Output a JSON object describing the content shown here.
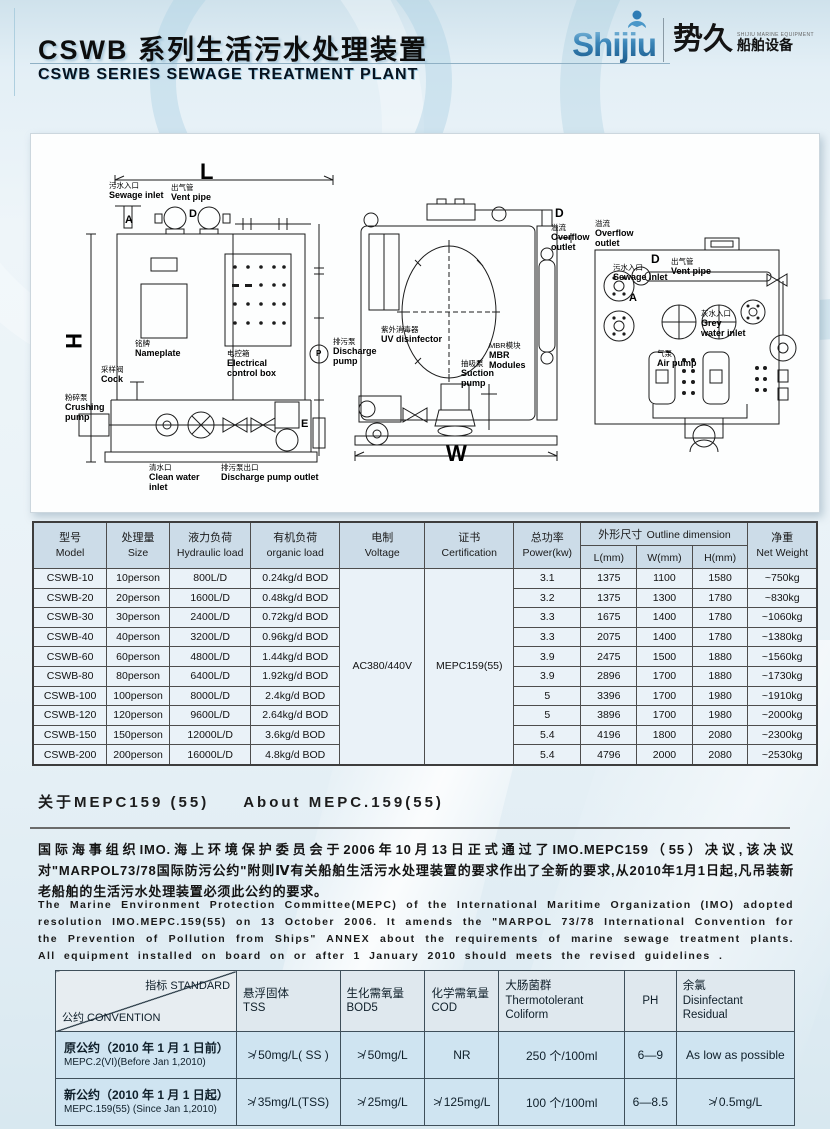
{
  "header": {
    "title_zh": "CSWB 系列生活污水处理装置",
    "title_en": "CSWB SERIES  SEWAGE TREATMENT PLANT",
    "logo": {
      "brand": "Shijiu",
      "name_zh": "势久",
      "sub_en": "SHIJIU MARINE EQUIPMENT",
      "sub_zh": "船舶设备"
    }
  },
  "colors": {
    "brand_blue": "#2e7cb5",
    "page_bg": "#e9f2f7",
    "table_header_bg": "#ccdce8",
    "table_body_bg": "#eaf2f8",
    "std_body_bg": "#cfe4f1",
    "line_dark": "#4d4d4d"
  },
  "diagram": {
    "front": {
      "marks": {
        "l": "L",
        "h": "H",
        "a": "A",
        "d": "D",
        "e": "E",
        "p": "P"
      },
      "labels": {
        "sewage_inlet": {
          "zh": "污水入口",
          "en": "Sewage inlet"
        },
        "vent_pipe": {
          "zh": "出气管",
          "en": "Vent pipe"
        },
        "nameplate": {
          "zh": "铭牌",
          "en": "Nameplate"
        },
        "electrical_box": {
          "zh": "电控箱",
          "en": "Electrical control box"
        },
        "cock": {
          "zh": "采样阀",
          "en": "Cock"
        },
        "crushing_pump": {
          "zh": "粉碎泵",
          "en": "Crushing pump"
        },
        "clean_water_inlet": {
          "zh": "清水口",
          "en": "Clean water inlet"
        },
        "discharge_pump_outlet": {
          "zh": "排污泵出口",
          "en": "Discharge pump outlet"
        }
      }
    },
    "side": {
      "marks": {
        "w": "W",
        "d": "D"
      },
      "labels": {
        "overflow_outlet": {
          "zh": "溢流",
          "en": "Overflow outlet"
        },
        "discharge_pump": {
          "zh": "排污泵",
          "en": "Discharge pump"
        },
        "uv_disinfector": {
          "zh": "紫外消毒器",
          "en": "UV disinfector"
        },
        "suction_pump": {
          "zh": "抽吸泵",
          "en": "Suction pump"
        },
        "mbr_modules": {
          "zh": "MBR模块",
          "en": "MBR Modules"
        }
      }
    },
    "top": {
      "marks": {
        "a": "A",
        "d": "D"
      },
      "labels": {
        "overflow_outlet": {
          "zh": "溢流",
          "en": "Overflow outlet"
        },
        "sewage_inlet": {
          "zh": "污水入口",
          "en": "Sewage inlet"
        },
        "vent_pipe": {
          "zh": "出气管",
          "en": "Vent pipe"
        },
        "grey_water_inlet": {
          "zh": "灰水入口",
          "en": "Grey water inlet"
        },
        "air_pump": {
          "zh": "气泵",
          "en": "Air pump"
        }
      }
    }
  },
  "spec_table": {
    "headers": {
      "model": {
        "zh": "型号",
        "en": "Model"
      },
      "size": {
        "zh": "处理量",
        "en": "Size"
      },
      "hydraulic": {
        "zh": "液力负荷",
        "en": "Hydraulic load"
      },
      "organic": {
        "zh": "有机负荷",
        "en": "organic load"
      },
      "voltage": {
        "zh": "电制",
        "en": "Voltage"
      },
      "certification": {
        "zh": "证书",
        "en": "Certification"
      },
      "power": {
        "zh": "总功率",
        "en": "Power(kw)"
      },
      "outline": {
        "zh": "外形尺寸",
        "en": "Outline dimension"
      },
      "l": "L(mm)",
      "w": "W(mm)",
      "h": "H(mm)",
      "net_weight": {
        "zh": "净重",
        "en": "Net Weight"
      }
    },
    "voltage_value": "AC380/440V",
    "certification_value": "MEPC159(55)",
    "rows": [
      {
        "model": "CSWB-10",
        "size": "10person",
        "hydraulic": "800L/D",
        "organic": "0.24kg/d BOD",
        "power": "3.1",
        "l": "1375",
        "w": "1100",
        "h": "1580",
        "weight": "~750kg"
      },
      {
        "model": "CSWB-20",
        "size": "20person",
        "hydraulic": "1600L/D",
        "organic": "0.48kg/d BOD",
        "power": "3.2",
        "l": "1375",
        "w": "1300",
        "h": "1780",
        "weight": "~830kg"
      },
      {
        "model": "CSWB-30",
        "size": "30person",
        "hydraulic": "2400L/D",
        "organic": "0.72kg/d BOD",
        "power": "3.3",
        "l": "1675",
        "w": "1400",
        "h": "1780",
        "weight": "~1060kg"
      },
      {
        "model": "CSWB-40",
        "size": "40person",
        "hydraulic": "3200L/D",
        "organic": "0.96kg/d BOD",
        "power": "3.3",
        "l": "2075",
        "w": "1400",
        "h": "1780",
        "weight": "~1380kg"
      },
      {
        "model": "CSWB-60",
        "size": "60person",
        "hydraulic": "4800L/D",
        "organic": "1.44kg/d BOD",
        "power": "3.9",
        "l": "2475",
        "w": "1500",
        "h": "1880",
        "weight": "~1560kg"
      },
      {
        "model": "CSWB-80",
        "size": "80person",
        "hydraulic": "6400L/D",
        "organic": "1.92kg/d BOD",
        "power": "3.9",
        "l": "2896",
        "w": "1700",
        "h": "1880",
        "weight": "~1730kg"
      },
      {
        "model": "CSWB-100",
        "size": "100person",
        "hydraulic": "8000L/D",
        "organic": "2.4kg/d BOD",
        "power": "5",
        "l": "3396",
        "w": "1700",
        "h": "1980",
        "weight": "~1910kg"
      },
      {
        "model": "CSWB-120",
        "size": "120person",
        "hydraulic": "9600L/D",
        "organic": "2.64kg/d BOD",
        "power": "5",
        "l": "3896",
        "w": "1700",
        "h": "1980",
        "weight": "~2000kg"
      },
      {
        "model": "CSWB-150",
        "size": "150person",
        "hydraulic": "12000L/D",
        "organic": "3.6kg/d BOD",
        "power": "5.4",
        "l": "4196",
        "w": "1800",
        "h": "2080",
        "weight": "~2300kg"
      },
      {
        "model": "CSWB-200",
        "size": "200person",
        "hydraulic": "16000L/D",
        "organic": "4.8kg/d BOD",
        "power": "5.4",
        "l": "4796",
        "w": "2000",
        "h": "2080",
        "weight": "~2530kg"
      }
    ]
  },
  "mepc": {
    "heading_zh": "关于MEPC159 (55)",
    "heading_en": "About MEPC.159(55)",
    "para_zh": "国际海事组织IMO.海上环境保护委员会于2006年10月13日正式通过了IMO.MEPC159（55）决议,该决议对\"MARPOL73/78国际防污公约\"附则Ⅳ有关船舶生活污水处理装置的要求作出了全新的要求,从2010年1月1日起,凡吊装新老船舶的生活污水处理装置必须此公约的要求。",
    "para_en": "The Marine Environment Protection Committee(MEPC) of the International Maritime Organization (IMO) adopted resolution IMO.MEPC.159(55) on 13 October 2006. It amends the \"MARPOL 73/78 International Convention for the Prevention of Pollution from Ships\" ANNEX about the requirements of marine sewage treatment plants. All equipment installed on board on or after 1 January 2010 should meets the revised guidelines ."
  },
  "standards_table": {
    "corner": {
      "top": "指标 STANDARD",
      "bottom": "公约 CONVENTION"
    },
    "columns": [
      {
        "zh": "悬浮固体",
        "en": "TSS"
      },
      {
        "zh": "生化需氧量",
        "en": "BOD5"
      },
      {
        "zh": "化学需氧量",
        "en": "COD"
      },
      {
        "zh": "大肠菌群",
        "en": "Thermotolerant Coliform"
      },
      {
        "zh": "PH",
        "en": ""
      },
      {
        "zh": "余氯",
        "en": "Disinfectant Residual"
      }
    ],
    "rows": [
      {
        "name_zh": "原公约（2010 年 1 月 1 日前）",
        "name_en": "MEPC.2(VI)(Before Jan 1,2010)",
        "tss": "≯ 50mg/L( SS )",
        "bod5": "≯ 50mg/L",
        "cod": "NR",
        "coliform": "250 个/100ml",
        "ph": "6—9",
        "residual": "As low as possible"
      },
      {
        "name_zh": "新公约（2010 年 1 月 1 日起）",
        "name_en": "MEPC.159(55) (Since Jan 1,2010)",
        "tss": "≯ 35mg/L(TSS)",
        "bod5": "≯ 25mg/L",
        "cod": "≯ 125mg/L",
        "coliform": "100 个/100ml",
        "ph": "6—8.5",
        "residual": "≯ 0.5mg/L"
      }
    ]
  }
}
